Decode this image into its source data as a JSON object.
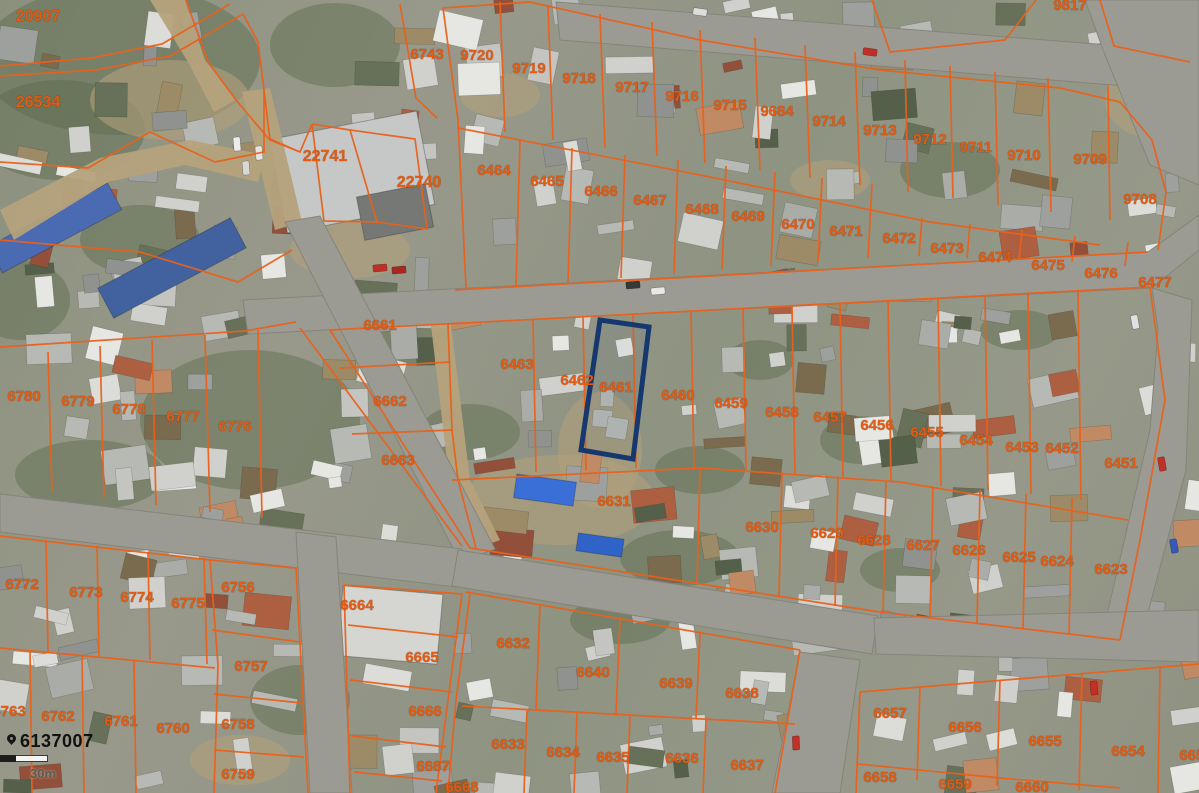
{
  "map": {
    "type": "cadastral-aerial-view",
    "overlay_color": "#e8611c",
    "selected_parcel": {
      "id": "6461",
      "outline_color": "#16386e",
      "polygon": [
        [
          600,
          320
        ],
        [
          649,
          327
        ],
        [
          633,
          459
        ],
        [
          581,
          450
        ]
      ]
    },
    "id_label": {
      "marker_icon": "location-marker-icon",
      "text": "6137007",
      "color": "#111111"
    },
    "scale_bar": {
      "label": "30m",
      "segments": [
        "dark",
        "light"
      ]
    },
    "parcel_labels": [
      {
        "t": "20907",
        "x": 38,
        "y": 17
      },
      {
        "t": "26534",
        "x": 38,
        "y": 103
      },
      {
        "t": "22741",
        "x": 325,
        "y": 157
      },
      {
        "t": "22740",
        "x": 419,
        "y": 183
      },
      {
        "t": "6743",
        "x": 427,
        "y": 55
      },
      {
        "t": "9720",
        "x": 477,
        "y": 56
      },
      {
        "t": "9719",
        "x": 529,
        "y": 69
      },
      {
        "t": "9718",
        "x": 579,
        "y": 79
      },
      {
        "t": "9717",
        "x": 632,
        "y": 88
      },
      {
        "t": "9716",
        "x": 682,
        "y": 97
      },
      {
        "t": "9715",
        "x": 730,
        "y": 106
      },
      {
        "t": "9684",
        "x": 777,
        "y": 112
      },
      {
        "t": "9714",
        "x": 829,
        "y": 122
      },
      {
        "t": "9713",
        "x": 880,
        "y": 131
      },
      {
        "t": "9712",
        "x": 930,
        "y": 140
      },
      {
        "t": "9711",
        "x": 976,
        "y": 148
      },
      {
        "t": "9710",
        "x": 1024,
        "y": 156
      },
      {
        "t": "9709",
        "x": 1090,
        "y": 160
      },
      {
        "t": "9708",
        "x": 1140,
        "y": 200
      },
      {
        "t": "9817",
        "x": 1070,
        "y": 6
      },
      {
        "t": "6464",
        "x": 494,
        "y": 171
      },
      {
        "t": "6465",
        "x": 547,
        "y": 182
      },
      {
        "t": "6466",
        "x": 601,
        "y": 192
      },
      {
        "t": "6467",
        "x": 650,
        "y": 201
      },
      {
        "t": "6468",
        "x": 702,
        "y": 210
      },
      {
        "t": "6469",
        "x": 748,
        "y": 217
      },
      {
        "t": "6470",
        "x": 798,
        "y": 225
      },
      {
        "t": "6471",
        "x": 846,
        "y": 232
      },
      {
        "t": "6472",
        "x": 899,
        "y": 239
      },
      {
        "t": "6473",
        "x": 947,
        "y": 249
      },
      {
        "t": "6474",
        "x": 995,
        "y": 258
      },
      {
        "t": "6475",
        "x": 1048,
        "y": 266
      },
      {
        "t": "6476",
        "x": 1101,
        "y": 274
      },
      {
        "t": "6477",
        "x": 1155,
        "y": 283
      },
      {
        "t": "6661",
        "x": 380,
        "y": 326
      },
      {
        "t": "6662",
        "x": 390,
        "y": 402
      },
      {
        "t": "6663",
        "x": 398,
        "y": 461
      },
      {
        "t": "6463",
        "x": 517,
        "y": 365
      },
      {
        "t": "6462",
        "x": 577,
        "y": 381
      },
      {
        "t": "6461",
        "x": 616,
        "y": 388
      },
      {
        "t": "6460",
        "x": 678,
        "y": 396
      },
      {
        "t": "6459",
        "x": 731,
        "y": 404
      },
      {
        "t": "6458",
        "x": 782,
        "y": 413
      },
      {
        "t": "6457",
        "x": 830,
        "y": 418
      },
      {
        "t": "6456",
        "x": 877,
        "y": 426
      },
      {
        "t": "6455",
        "x": 927,
        "y": 433
      },
      {
        "t": "6454",
        "x": 976,
        "y": 441
      },
      {
        "t": "6453",
        "x": 1022,
        "y": 448
      },
      {
        "t": "6452",
        "x": 1062,
        "y": 449
      },
      {
        "t": "6451",
        "x": 1121,
        "y": 464
      },
      {
        "t": "6631",
        "x": 614,
        "y": 502
      },
      {
        "t": "6630",
        "x": 762,
        "y": 528
      },
      {
        "t": "6629",
        "x": 827,
        "y": 534
      },
      {
        "t": "6628",
        "x": 874,
        "y": 541
      },
      {
        "t": "6627",
        "x": 923,
        "y": 546
      },
      {
        "t": "6626",
        "x": 969,
        "y": 551
      },
      {
        "t": "6625",
        "x": 1019,
        "y": 558
      },
      {
        "t": "6624",
        "x": 1057,
        "y": 562
      },
      {
        "t": "6623",
        "x": 1111,
        "y": 570
      },
      {
        "t": "6780",
        "x": 24,
        "y": 397
      },
      {
        "t": "6779",
        "x": 78,
        "y": 402
      },
      {
        "t": "6778",
        "x": 129,
        "y": 410
      },
      {
        "t": "6777",
        "x": 183,
        "y": 417
      },
      {
        "t": "6776",
        "x": 235,
        "y": 427
      },
      {
        "t": "6772",
        "x": 22,
        "y": 585
      },
      {
        "t": "6773",
        "x": 86,
        "y": 593
      },
      {
        "t": "6774",
        "x": 137,
        "y": 598
      },
      {
        "t": "6775",
        "x": 188,
        "y": 604
      },
      {
        "t": "6756",
        "x": 238,
        "y": 588
      },
      {
        "t": "6757",
        "x": 251,
        "y": 667
      },
      {
        "t": "6763",
        "x": 9,
        "y": 712
      },
      {
        "t": "6762",
        "x": 58,
        "y": 717
      },
      {
        "t": "6761",
        "x": 121,
        "y": 722
      },
      {
        "t": "6760",
        "x": 173,
        "y": 729
      },
      {
        "t": "6758",
        "x": 238,
        "y": 725
      },
      {
        "t": "6759",
        "x": 238,
        "y": 775
      },
      {
        "t": "6664",
        "x": 357,
        "y": 606
      },
      {
        "t": "6665",
        "x": 422,
        "y": 658
      },
      {
        "t": "6666",
        "x": 425,
        "y": 712
      },
      {
        "t": "6667",
        "x": 433,
        "y": 767
      },
      {
        "t": "6668",
        "x": 462,
        "y": 788
      },
      {
        "t": "6632",
        "x": 513,
        "y": 644
      },
      {
        "t": "6640",
        "x": 593,
        "y": 673
      },
      {
        "t": "6639",
        "x": 676,
        "y": 684
      },
      {
        "t": "6638",
        "x": 742,
        "y": 694
      },
      {
        "t": "6633",
        "x": 508,
        "y": 745
      },
      {
        "t": "6634",
        "x": 563,
        "y": 753
      },
      {
        "t": "6635",
        "x": 613,
        "y": 758
      },
      {
        "t": "6636",
        "x": 682,
        "y": 759
      },
      {
        "t": "6637",
        "x": 747,
        "y": 766
      },
      {
        "t": "6657",
        "x": 890,
        "y": 714
      },
      {
        "t": "6656",
        "x": 965,
        "y": 728
      },
      {
        "t": "6655",
        "x": 1045,
        "y": 742
      },
      {
        "t": "6654",
        "x": 1128,
        "y": 752
      },
      {
        "t": "6653",
        "x": 1196,
        "y": 756
      },
      {
        "t": "6658",
        "x": 880,
        "y": 778
      },
      {
        "t": "6659",
        "x": 955,
        "y": 785
      },
      {
        "t": "6660",
        "x": 1032,
        "y": 788
      }
    ]
  }
}
